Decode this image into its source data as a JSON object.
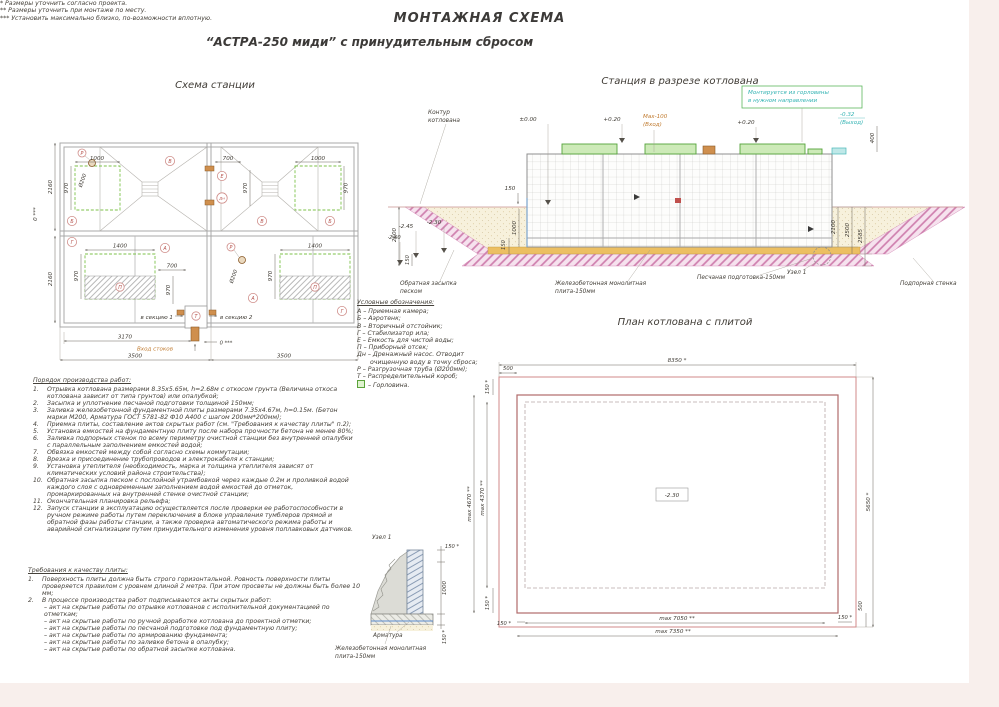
{
  "page": {
    "title_line1": "МОНТАЖНАЯ СХЕМА",
    "title_line2": "“АСТРА-250 миди” с принудительным сбросом"
  },
  "station_plan": {
    "title": "Схема станции",
    "letters": {
      "r": "Р",
      "v": "В",
      "b": "Б",
      "e": "Е",
      "dn": "Дн",
      "g": "Г",
      "a": "А",
      "p": "П",
      "t": "Т"
    },
    "dims": {
      "d1000": "1000",
      "d970": "970",
      "d700": "700",
      "d1400": "1400",
      "dia200": "Ø200",
      "d2160": "2160",
      "d3170": "3170",
      "d3500": "3500",
      "zero": "0 ***"
    },
    "labels": {
      "inlet": "Вход стоков",
      "sec1": "в секцию 1",
      "sec2": "в секцию 2"
    }
  },
  "section_view": {
    "title": "Станция в разрезе котлована",
    "note_line1": "Монтируется из горловины",
    "note_line2": "в нужном направлении",
    "labels": {
      "contour1": "Контур",
      "contour2": "котлована",
      "backfill1": "Обратная засыпка",
      "backfill2": "песком",
      "slab1": "Железобетонная монолитная",
      "slab2": "плита-150мм",
      "sand": "Песчаная подготовка-150мм",
      "wall": "Подпорная стенка",
      "node": "Узел 1"
    },
    "marks": {
      "zero": "±0.00",
      "p020": "+0.20",
      "max100": "Max-100",
      "inlet": "(Вход)",
      "m032": "-0.32",
      "outlet": "(Выход)"
    },
    "dims": {
      "d2600": "2600",
      "m245": "-2.45",
      "m230": "-2.30",
      "m260": "-2.60",
      "d150": "150",
      "d1000": "1000",
      "d400": "400",
      "d2100": "2100",
      "d2500": "2500",
      "d2585": "2585"
    }
  },
  "pit_plan": {
    "title": "План котлована с плитой",
    "depth": "-2.30",
    "dims": {
      "width_outer": "8350 *",
      "off500": "500",
      "off150": "150 *",
      "left_plate": "max 4670 **",
      "left_station": "max 4370 **",
      "height_outer": "5650 *",
      "bottom_station": "max 7050 **",
      "bottom_plate": "max 7350 **"
    }
  },
  "node1": {
    "title": "Узел 1",
    "dims": {
      "d150": "150 *",
      "d1000": "1000"
    },
    "labels": {
      "rebar": "Арматура",
      "slab1": "Железобетонная монолитная",
      "slab2": "плита-150мм"
    }
  },
  "legend": {
    "title": "Условные обозначения:",
    "items": [
      "А – Приемная камера;",
      "Б – Аэротенк;",
      "В – Вторичный отстойник;",
      "Г – Стабилизатор ила;",
      "Е – Емкость для чистой воды;",
      "П – Приборный отсек;",
      "Дн – Дренажный насос. Отводит очищенную воду в точку сброса;",
      "Р – Разгрузочная труба (Ø200мм);",
      "Т – Распределительный короб;"
    ],
    "last": "–  Горловина."
  },
  "work_order": {
    "title": "Порядок производства работ:",
    "items": [
      {
        "n": "1.",
        "t": "Отрывка котлована размерами 8.35х5.65м, h=2.68м с откосом грунта (Величина откоса котлована зависит от типа грунтов) или опалубкой;"
      },
      {
        "n": "2.",
        "t": "Засыпка и уплотнение песчаной подготовки толщиной 150мм;"
      },
      {
        "n": "3.",
        "t": "Заливка железобетонной фундаментной плиты размерами 7.35х4.67м, h=0.15м. (Бетон марки М200, Арматура ГОСТ 5781-82 Ф10 А400 с шагом 200мм*200мм);"
      },
      {
        "n": "4.",
        "t": "Приемка плиты, составление актов скрытых работ (см. \"Требования к качеству плиты\" п.2);"
      },
      {
        "n": "5.",
        "t": "Установка емкостей на фундаментную плиту после набора прочности бетона не менее  80%;"
      },
      {
        "n": "6.",
        "t": "Заливка подпорных стенок по всему периметру очистной станции без внутренней опалубки с параллельным заполнением емкостей водой;"
      },
      {
        "n": "7.",
        "t": "Обвязка емкостей между собой согласно схемы коммутации;"
      },
      {
        "n": "8.",
        "t": "Врезка и присоединение трубопроводов и электрокабеля к станции;"
      },
      {
        "n": "9.",
        "t": "Установка утеплителя (необходимость, марка и толщина утеплителя зависят от климатических условий района строительства);"
      },
      {
        "n": "10.",
        "t": "Обратная засыпка песком с послойной утрамбовкой через каждые 0.2м и проливкой водой каждого слоя с одновременным заполнением водой емкостей до отметок, промаркированных на внутренней стенке очистной станции;"
      },
      {
        "n": "11.",
        "t": "Окончательная планировка рельефа;"
      },
      {
        "n": "12.",
        "t": "Запуск станции в эксплуатацию осуществляется после проверки ее работоспособности в ручном режиме работы путем переключения в блоке управления тумблеров прямой и обратной фазы работы станции, а также проверка автоматического режима работы и аварийной сигнализации путем принудительного изменения уровня поплавковых датчиков."
      }
    ]
  },
  "requirements": {
    "title": "Требования к качеству плиты:",
    "items": [
      {
        "n": "1.",
        "t": "Поверхность плиты должна быть строго горизонтальной. Ровность поверхности плиты проверяется правилом с уровнем длиной 2 метра. При этом просветы не должны быть    более 10 мм;"
      },
      {
        "n": "2.",
        "t": "В процессе производства работ подписываются акты скрытых работ:"
      }
    ],
    "acts": [
      "– акт на скрытые работы по отрывке котлованов с исполнительной документацией по отметкам;",
      "– акт на скрытые работы по ручной доработке котлована до проектной отметки;",
      "– акт на скрытые работы по песчаной подготовке под фундаментную плиту;",
      "– акт на скрытые работы по армированию фундамента;",
      "– акт на скрытые работы по заливке бетона в опалубку;",
      "– акт на скрытые работы по обратной засыпке котлована."
    ]
  },
  "footnotes": [
    "*  Размеры уточнить согласно проекта.",
    "** Размеры уточнить при монтаже по месту.",
    "*** Установить максимально близко, по-возможности вплотную."
  ]
}
